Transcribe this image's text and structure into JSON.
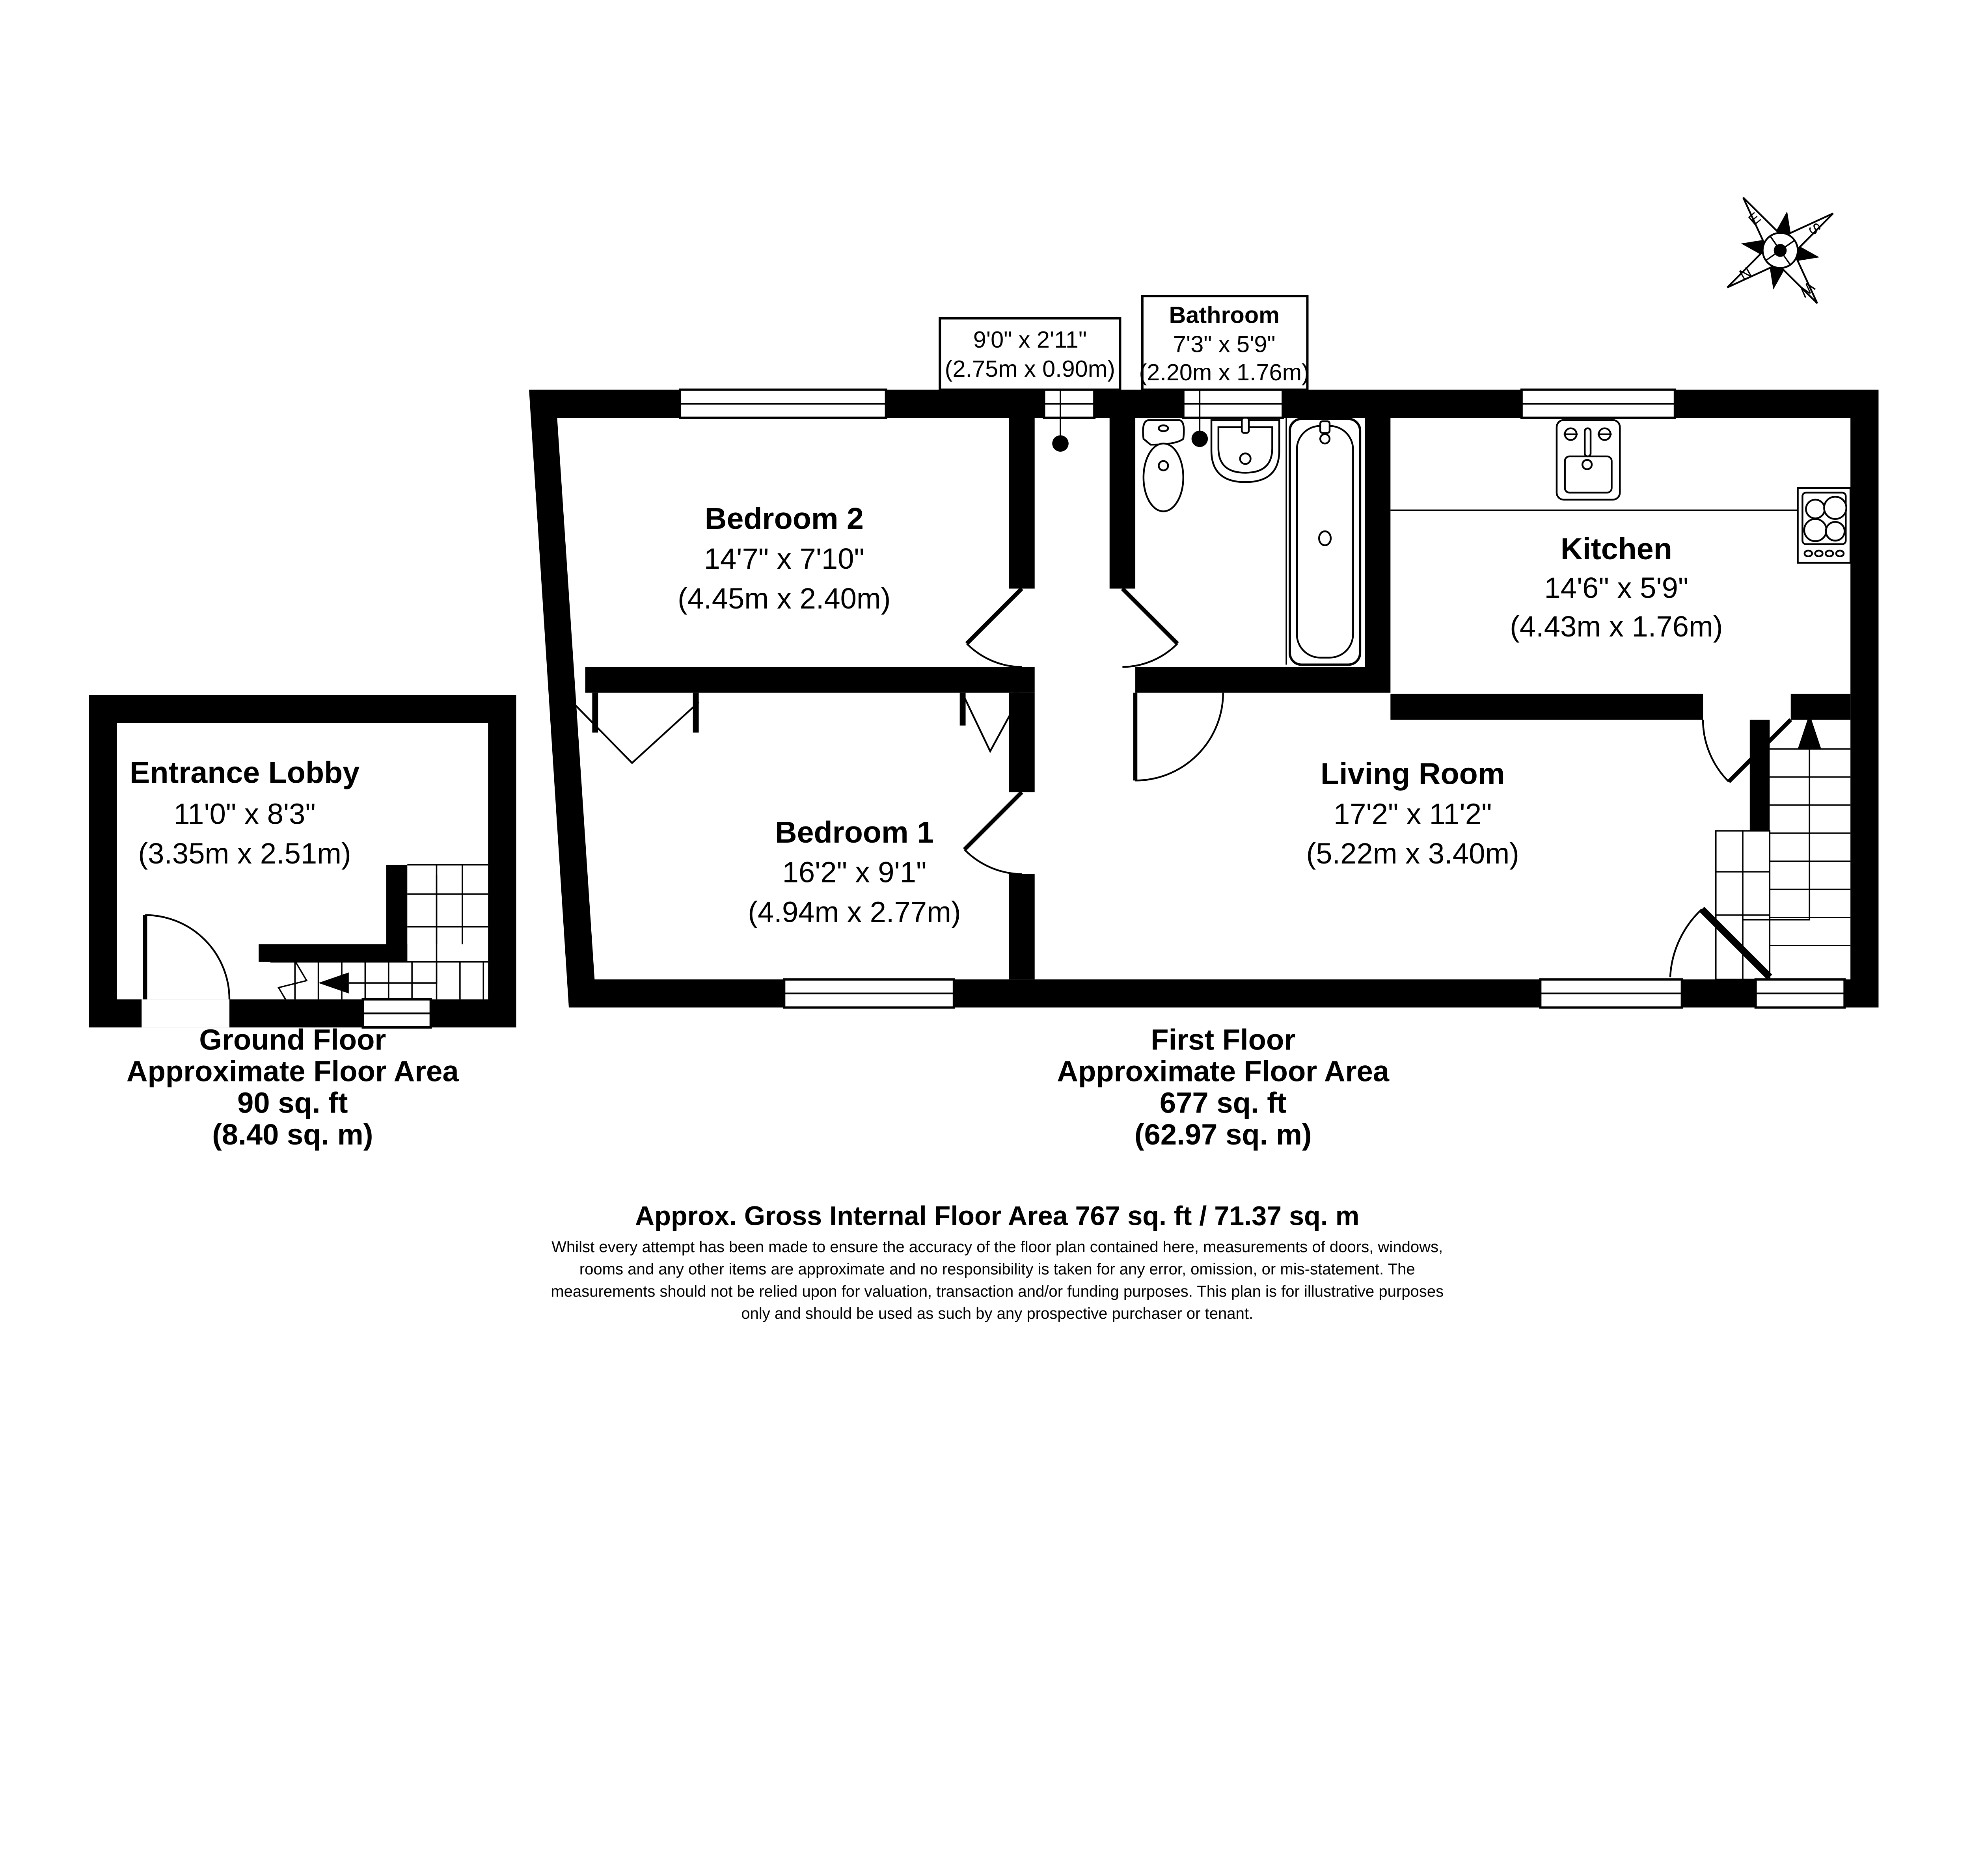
{
  "rooms": {
    "bedroom2": {
      "name": "Bedroom 2",
      "imperial": "14'7\" x 7'10\"",
      "metric": "(4.45m x 2.40m)"
    },
    "bedroom1": {
      "name": "Bedroom 1",
      "imperial": "16'2\" x 9'1\"",
      "metric": "(4.94m x 2.77m)"
    },
    "living": {
      "name": "Living Room",
      "imperial": "17'2\" x 11'2\"",
      "metric": "(5.22m x 3.40m)"
    },
    "kitchen": {
      "name": "Kitchen",
      "imperial": "14'6\" x 5'9\"",
      "metric": "(4.43m x 1.76m)"
    },
    "lobby": {
      "name": "Entrance Lobby",
      "imperial": "11'0\" x 8'3\"",
      "metric": "(3.35m x 2.51m)"
    }
  },
  "callouts": {
    "hall": {
      "imperial": "9'0\" x 2'11\"",
      "metric": "(2.75m x 0.90m)"
    },
    "bathroom": {
      "name": "Bathroom",
      "imperial": "7'3\" x 5'9\"",
      "metric": "(2.20m x 1.76m)"
    }
  },
  "floors": {
    "ground": {
      "title": "Ground Floor",
      "subtitle": "Approximate Floor Area",
      "area_ft": "90 sq. ft",
      "area_m": "(8.40 sq. m)"
    },
    "first": {
      "title": "First Floor",
      "subtitle": "Approximate Floor Area",
      "area_ft": "677 sq. ft",
      "area_m": "(62.97 sq. m)"
    }
  },
  "footer": {
    "title": "Approx. Gross Internal Floor Area 767 sq. ft / 71.37 sq. m",
    "disclaimer_lines": [
      "Whilst every attempt has been made to ensure the accuracy of the floor plan contained here, measurements of doors, windows,",
      "rooms and any other items are approximate and no responsibility is taken for any error, omission, or mis-statement. The",
      "measurements should not be relied upon for valuation, transaction and/or funding purposes. This plan is for illustrative purposes",
      "only and should be used as such by any prospective purchaser or tenant."
    ]
  },
  "compass": {
    "n": "N",
    "e": "E",
    "s": "S",
    "w": "W"
  },
  "colors": {
    "ink": "#000000",
    "paper": "#ffffff"
  }
}
